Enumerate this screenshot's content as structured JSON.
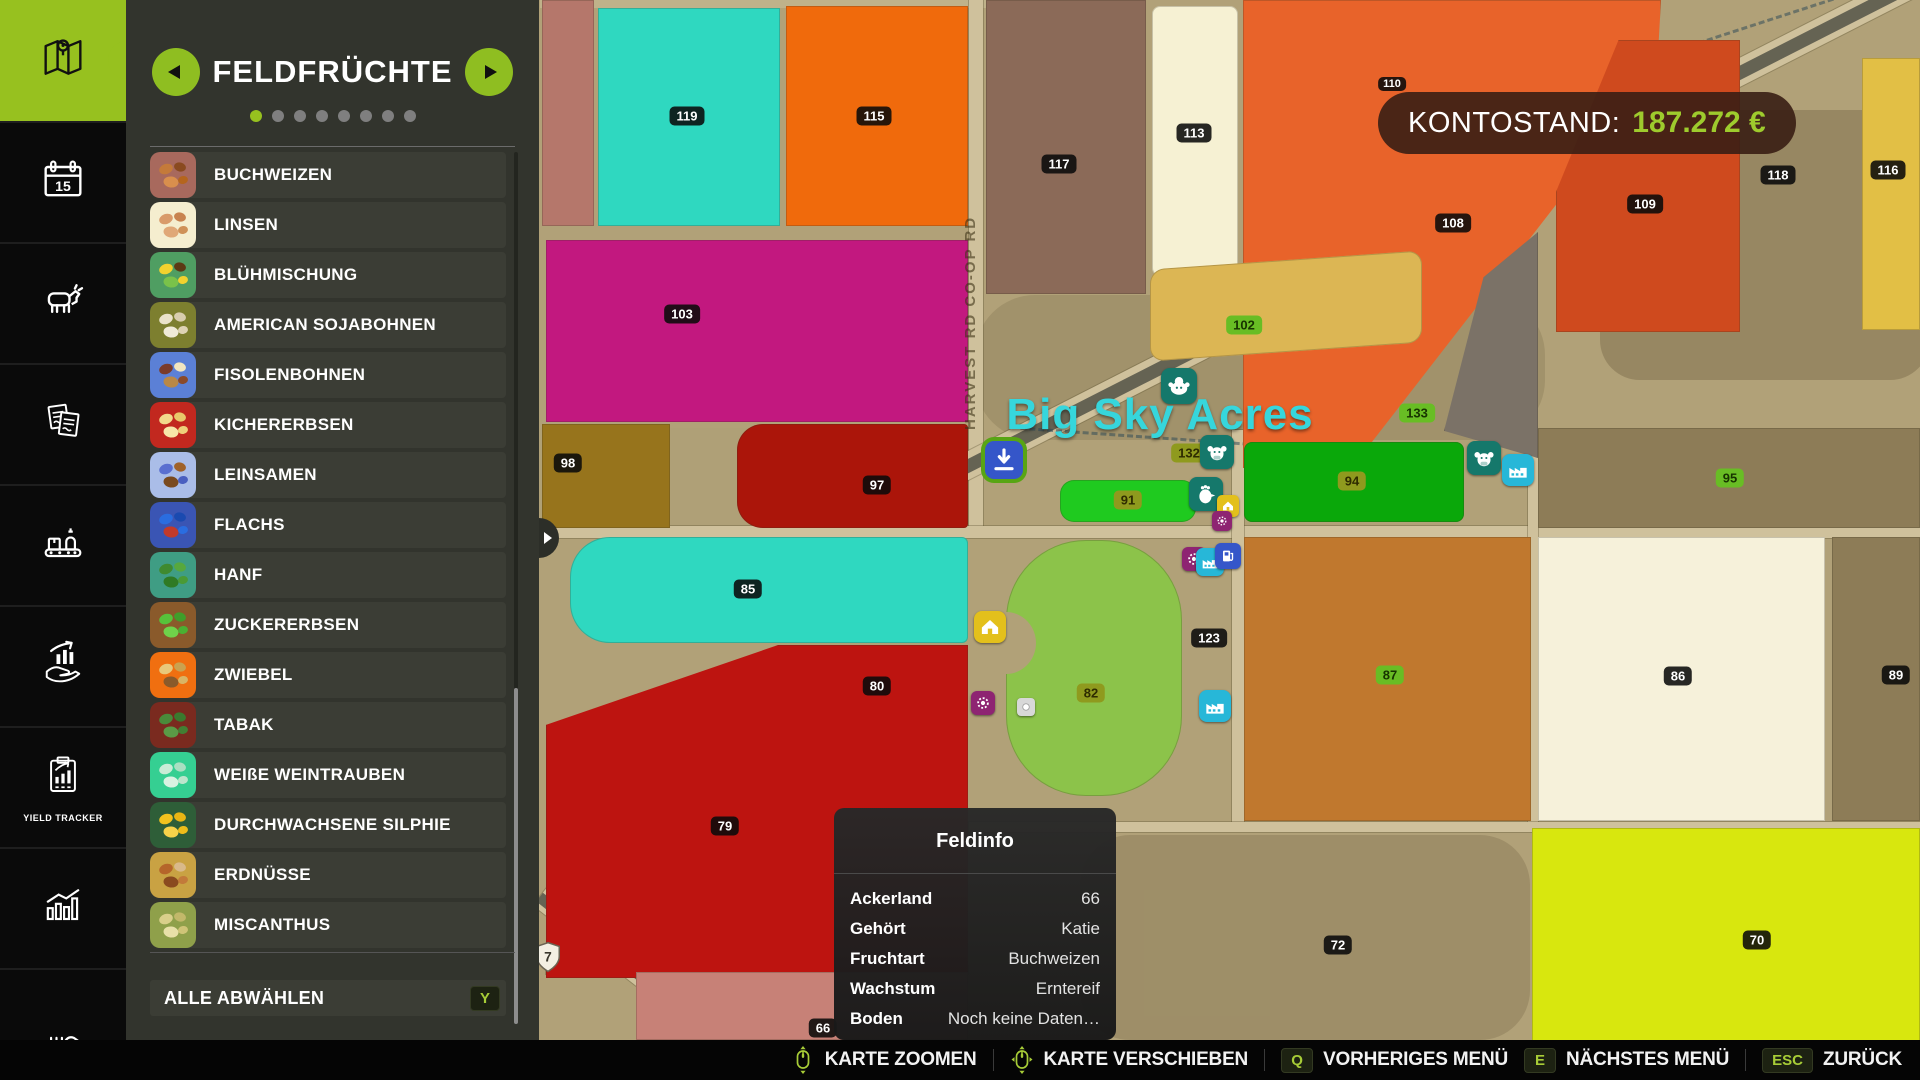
{
  "sidebar": {
    "items": [
      {
        "name": "map",
        "active": true
      },
      {
        "name": "calendar"
      },
      {
        "name": "animals"
      },
      {
        "name": "contracts"
      },
      {
        "name": "production"
      },
      {
        "name": "sales"
      },
      {
        "name": "yield-tracker",
        "label": "YIELD TRACKER"
      },
      {
        "name": "statistics"
      },
      {
        "name": "misc"
      }
    ]
  },
  "panel": {
    "title": "FELDFRÜCHTE",
    "page_dots": {
      "count": 8,
      "active": 0
    },
    "crops": [
      {
        "label": "BUCHWEIZEN",
        "tile": "#a8695d",
        "seeds": [
          "#c47a3a",
          "#8a4a1f",
          "#d98f4d",
          "#b5651d"
        ]
      },
      {
        "label": "LINSEN",
        "tile": "#f5eecf",
        "seeds": [
          "#d99b6a",
          "#c8834f",
          "#e0a877",
          "#cf9157"
        ]
      },
      {
        "label": "BLÜHMISCHUNG",
        "tile": "#4f9e62",
        "seeds": [
          "#f2d22e",
          "#5c3a14",
          "#7ac24a",
          "#f2d22e"
        ]
      },
      {
        "label": "AMERICAN SOJABOHNEN",
        "tile": "#7d7f2f",
        "seeds": [
          "#eae2c9",
          "#d8cdae",
          "#f0ead7",
          "#ded3b5"
        ]
      },
      {
        "label": "FISOLENBOHNEN",
        "tile": "#5b80d6",
        "seeds": [
          "#7a3b2a",
          "#f2e6c0",
          "#b98847",
          "#8a4a2a"
        ]
      },
      {
        "label": "KICHERERBSEN",
        "tile": "#c2281f",
        "seeds": [
          "#f2d98a",
          "#e8c96a",
          "#f7e6a8",
          "#eed07a"
        ]
      },
      {
        "label": "LEINSAMEN",
        "tile": "#aabde8",
        "seeds": [
          "#5a6fd0",
          "#a0622a",
          "#7a4a1f",
          "#4a5fc0"
        ]
      },
      {
        "label": "FLACHS",
        "tile": "#3a55b4",
        "seeds": [
          "#2a6de0",
          "#1a4ab0",
          "#c23a2a",
          "#2a6de0"
        ]
      },
      {
        "label": "HANF",
        "tile": "#3f9d84",
        "seeds": [
          "#3f8a2f",
          "#57a83d",
          "#2f7a24",
          "#4a9a35"
        ]
      },
      {
        "label": "ZUCKERERBSEN",
        "tile": "#8a5a2b",
        "seeds": [
          "#57c23a",
          "#3f9e2a",
          "#6fd24a",
          "#4ab032"
        ]
      },
      {
        "label": "ZWIEBEL",
        "tile": "#f06f10",
        "seeds": [
          "#e8c87a",
          "#caa24f",
          "#8a5a2a",
          "#d9b565"
        ]
      },
      {
        "label": "TABAK",
        "tile": "#7a2a1f",
        "seeds": [
          "#4a8a3a",
          "#3a7a2e",
          "#5a9a46",
          "#427f33"
        ]
      },
      {
        "label": "WEIßE WEINTRAUBEN",
        "tile": "#35cf92",
        "seeds": [
          "#c8ecd6",
          "#aadfc2",
          "#d8f2e2",
          "#bce5cc"
        ]
      },
      {
        "label": "DURCHWACHSENE SILPHIE",
        "tile": "#2e5e38",
        "seeds": [
          "#f2c21e",
          "#e8b514",
          "#f7d24a",
          "#eebd1a"
        ]
      },
      {
        "label": "ERDNÜSSE",
        "tile": "#c9a243",
        "seeds": [
          "#b5652a",
          "#d9b98a",
          "#8a4a1f",
          "#c27a3a"
        ]
      },
      {
        "label": "MISCANTHUS",
        "tile": "#8fa04a",
        "seeds": [
          "#d9cf8a",
          "#c2b86a",
          "#e8e0a8",
          "#cfc477"
        ]
      }
    ],
    "deselect": {
      "label": "ALLE ABWÄHLEN",
      "key": "Y"
    }
  },
  "hud": {
    "balance_label": "KONTOSTAND:",
    "balance_value": "187.272 €",
    "balance_value_color": "#9ecb2d"
  },
  "map": {
    "title": "Big Sky Acres",
    "title_color": "#36d6dc",
    "title_x": 1160,
    "title_y": 415,
    "road_label": "HARVEST RD CO-OP RD",
    "ground": "#b1a178",
    "shield": {
      "text": "7",
      "x": 548,
      "y": 957
    },
    "fields": [
      {
        "id": "",
        "x": 542,
        "y": 0,
        "w": 52,
        "h": 226,
        "color": "#b5776b"
      },
      {
        "id": "119",
        "x": 598,
        "y": 8,
        "w": 182,
        "h": 218,
        "color": "#2fd8c0"
      },
      {
        "id": "115",
        "x": 786,
        "y": 6,
        "w": 182,
        "h": 220,
        "color": "#f06a0c"
      },
      {
        "id": "117",
        "x": 986,
        "y": 0,
        "w": 160,
        "h": 294,
        "color": "#8b6a58"
      },
      {
        "id": "113",
        "x": 1152,
        "y": 6,
        "w": 86,
        "h": 270,
        "color": "#f6f1d3",
        "r": "8px"
      },
      {
        "id": "110",
        "x": 1243,
        "y": 0,
        "w": 418,
        "h": 468,
        "color": "#e8632a",
        "clip": "polygon(0 0,100% 0,99% 16%,26% 100%,0 100%)"
      },
      {
        "id": "109",
        "x": 1556,
        "y": 40,
        "w": 184,
        "h": 292,
        "color": "#cf4a1e",
        "clip": "polygon(34% 0,100% 0,100% 100%,0 100%,0 52%)"
      },
      {
        "id": "116",
        "x": 1862,
        "y": 58,
        "w": 58,
        "h": 272,
        "color": "#e2bf45"
      },
      {
        "id": "108",
        "x": 1444,
        "y": 232,
        "w": 94,
        "h": 226,
        "color": "#7b7267",
        "clip": "polygon(100% 0,100% 100%,0 88%,42% 20%)"
      },
      {
        "id": "102",
        "x": 1150,
        "y": 260,
        "w": 272,
        "h": 92,
        "color": "#dcb654",
        "r": "14px",
        "transform": "skewY(-4deg)"
      },
      {
        "id": "103",
        "x": 546,
        "y": 240,
        "w": 422,
        "h": 182,
        "color": "#c2187f"
      },
      {
        "id": "98",
        "x": 542,
        "y": 424,
        "w": 128,
        "h": 104,
        "color": "#97741c"
      },
      {
        "id": "97",
        "x": 737,
        "y": 424,
        "w": 231,
        "h": 104,
        "color": "#ab150a",
        "r": "26px 4px 4px 26px"
      },
      {
        "id": "85",
        "x": 570,
        "y": 537,
        "w": 398,
        "h": 106,
        "color": "#2fd8c0",
        "r": "40px 6px 6px 40px"
      },
      {
        "id": "94",
        "x": 1244,
        "y": 442,
        "w": 220,
        "h": 80,
        "color": "#0aa80a",
        "r": "8px"
      },
      {
        "id": "91",
        "x": 1060,
        "y": 480,
        "w": 136,
        "h": 42,
        "color": "#1fca1f",
        "r": "14px"
      },
      {
        "id": "95",
        "x": 1538,
        "y": 428,
        "w": 382,
        "h": 100,
        "color": "#8d7c57"
      },
      {
        "id": "82",
        "x": 1006,
        "y": 540,
        "w": 176,
        "h": 256,
        "color": "#8cc34a",
        "r": "80px"
      },
      {
        "id": "87",
        "x": 1244,
        "y": 537,
        "w": 287,
        "h": 284,
        "color": "#c0782e"
      },
      {
        "id": "86",
        "x": 1538,
        "y": 537,
        "w": 287,
        "h": 284,
        "color": "#f6f1da"
      },
      {
        "id": "89",
        "x": 1832,
        "y": 537,
        "w": 88,
        "h": 284,
        "color": "#8d7c57"
      },
      {
        "id": "79",
        "x": 546,
        "y": 645,
        "w": 422,
        "h": 333,
        "color": "#bd1410",
        "clip": "polygon(0 24%,55% 0,100% 0,100% 100%,0 100%)"
      },
      {
        "id": "66",
        "x": 636,
        "y": 972,
        "w": 332,
        "h": 68,
        "color": "#c78177"
      },
      {
        "id": "70",
        "x": 1532,
        "y": 828,
        "w": 388,
        "h": 225,
        "color": "#d8e70e"
      }
    ],
    "badges": [
      {
        "text": "119",
        "x": 687,
        "y": 116,
        "style": "dark"
      },
      {
        "text": "115",
        "x": 874,
        "y": 116,
        "style": "dark"
      },
      {
        "text": "117",
        "x": 1059,
        "y": 164,
        "style": "dark"
      },
      {
        "text": "113",
        "x": 1194,
        "y": 133,
        "style": "dark"
      },
      {
        "text": "110",
        "x": 1392,
        "y": 84,
        "style": "dark",
        "small": true
      },
      {
        "text": "108",
        "x": 1453,
        "y": 223,
        "style": "dark"
      },
      {
        "text": "109",
        "x": 1645,
        "y": 204,
        "style": "dark"
      },
      {
        "text": "118",
        "x": 1778,
        "y": 175,
        "style": "dark"
      },
      {
        "text": "116",
        "x": 1888,
        "y": 170,
        "style": "dark"
      },
      {
        "text": "103",
        "x": 682,
        "y": 314,
        "style": "dark"
      },
      {
        "text": "102",
        "x": 1244,
        "y": 325,
        "style": "green"
      },
      {
        "text": "133",
        "x": 1417,
        "y": 413,
        "style": "green"
      },
      {
        "text": "98",
        "x": 568,
        "y": 463,
        "style": "dark"
      },
      {
        "text": "97",
        "x": 877,
        "y": 485,
        "style": "dark"
      },
      {
        "text": "132",
        "x": 1189,
        "y": 453,
        "style": "olive"
      },
      {
        "text": "91",
        "x": 1128,
        "y": 500,
        "style": "olive"
      },
      {
        "text": "94",
        "x": 1352,
        "y": 481,
        "style": "olive"
      },
      {
        "text": "95",
        "x": 1730,
        "y": 478,
        "style": "green"
      },
      {
        "text": "85",
        "x": 748,
        "y": 589,
        "style": "dark"
      },
      {
        "text": "80",
        "x": 877,
        "y": 686,
        "style": "dark"
      },
      {
        "text": "79",
        "x": 725,
        "y": 826,
        "style": "dark"
      },
      {
        "text": "123",
        "x": 1209,
        "y": 638,
        "style": "dark"
      },
      {
        "text": "82",
        "x": 1091,
        "y": 693,
        "style": "olive"
      },
      {
        "text": "87",
        "x": 1390,
        "y": 675,
        "style": "green"
      },
      {
        "text": "86",
        "x": 1678,
        "y": 676,
        "style": "dark"
      },
      {
        "text": "89",
        "x": 1896,
        "y": 675,
        "style": "dark"
      },
      {
        "text": "72",
        "x": 1338,
        "y": 945,
        "style": "dark"
      },
      {
        "text": "70",
        "x": 1757,
        "y": 940,
        "style": "dark"
      },
      {
        "text": "66",
        "x": 823,
        "y": 1028,
        "style": "dark"
      }
    ],
    "icons": [
      {
        "type": "bison-icon",
        "x": 1179,
        "y": 386,
        "color": "#15786b",
        "size": 36
      },
      {
        "type": "buy-point-icon",
        "x": 1004,
        "y": 460,
        "color": "#3556c9",
        "size": 38,
        "ring": true
      },
      {
        "type": "cow-icon",
        "x": 1217,
        "y": 452,
        "color": "#15786b",
        "size": 34
      },
      {
        "type": "chicken-icon",
        "x": 1206,
        "y": 494,
        "color": "#15786b",
        "size": 34
      },
      {
        "type": "house-icon",
        "x": 1228,
        "y": 506,
        "color": "#e3c01c",
        "size": 22
      },
      {
        "type": "gear-icon",
        "x": 1222,
        "y": 521,
        "color": "#8e2472",
        "size": 20
      },
      {
        "type": "cow-icon",
        "x": 1484,
        "y": 458,
        "color": "#15786b",
        "size": 34
      },
      {
        "type": "factory-icon",
        "x": 1518,
        "y": 470,
        "color": "#27b7d8",
        "size": 32
      },
      {
        "type": "gear-icon",
        "x": 1194,
        "y": 559,
        "color": "#8e2472",
        "size": 24
      },
      {
        "type": "factory-icon",
        "x": 1210,
        "y": 562,
        "color": "#27b7d8",
        "size": 28
      },
      {
        "type": "fuel-icon",
        "x": 1228,
        "y": 556,
        "color": "#3556c9",
        "size": 26
      },
      {
        "type": "factory-icon",
        "x": 1215,
        "y": 706,
        "color": "#27b7d8",
        "size": 32
      },
      {
        "type": "house-icon",
        "x": 990,
        "y": 627,
        "color": "#e3c01c",
        "size": 32
      },
      {
        "type": "gear-icon",
        "x": 983,
        "y": 703,
        "color": "#8e2472",
        "size": 24
      },
      {
        "type": "dot-icon",
        "x": 1026,
        "y": 707,
        "color": "#d8d8d8",
        "size": 18
      }
    ]
  },
  "fieldinfo": {
    "title": "Feldinfo",
    "rows": [
      {
        "label": "Ackerland",
        "value": "66"
      },
      {
        "label": "Gehört",
        "value": "Katie"
      },
      {
        "label": "Fruchtart",
        "value": "Buchweizen"
      },
      {
        "label": "Wachstum",
        "value": "Erntereif"
      },
      {
        "label": "Boden",
        "value": "Noch keine Daten…"
      }
    ]
  },
  "bottombar": {
    "items": [
      {
        "type": "icon",
        "icon": "mouse-scroll-icon",
        "label": "KARTE ZOOMEN"
      },
      {
        "type": "sep"
      },
      {
        "type": "icon",
        "icon": "mouse-move-icon",
        "label": "KARTE VERSCHIEBEN"
      },
      {
        "type": "sep"
      },
      {
        "type": "key",
        "key": "Q",
        "label": "VORHERIGES MENÜ"
      },
      {
        "type": "key",
        "key": "E",
        "label": "NÄCHSTES MENÜ"
      },
      {
        "type": "sep"
      },
      {
        "type": "key",
        "key": "ESC",
        "label": "ZURÜCK"
      }
    ]
  }
}
